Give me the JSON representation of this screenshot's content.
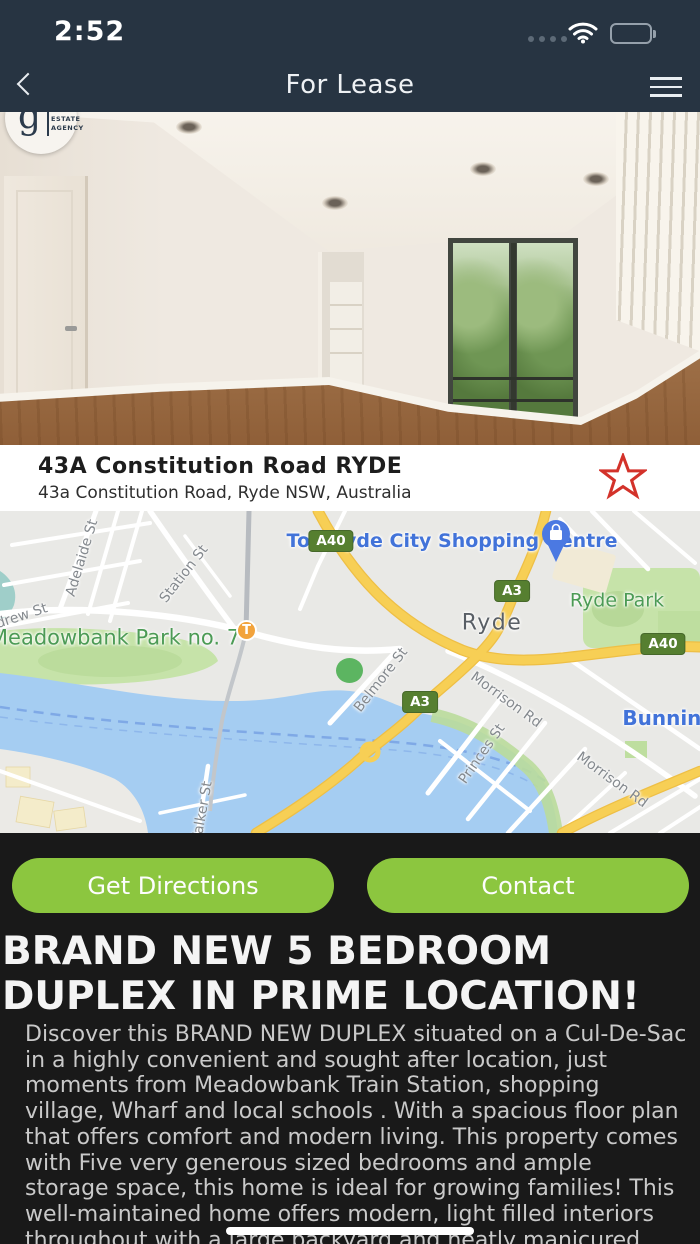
{
  "status_bar": {
    "time": "2:52"
  },
  "nav": {
    "title": "For Lease"
  },
  "agency_logo": {
    "monogram": "g",
    "text": "REAL\nESTATE\nAGENCY"
  },
  "property": {
    "title": "43A Constitution Road RYDE",
    "address": "43a Constitution Road, Ryde NSW, Australia"
  },
  "map": {
    "poi": {
      "shopping_centre_lines": [
        "Top Ryde City",
        "Shopping Centre"
      ],
      "meadowbank_park_lines": [
        "Meadowbank",
        "Park no. 7"
      ],
      "ryde_park": "Ryde Park",
      "locality": "Ryde",
      "bunnings": "Bunnings"
    },
    "shields": [
      {
        "label": "A40"
      },
      {
        "label": "A3"
      },
      {
        "label": "A40"
      },
      {
        "label": "A3"
      }
    ],
    "streets": [
      {
        "label": "Adelaide St"
      },
      {
        "label": "Station St"
      },
      {
        "label": "Andrew St"
      },
      {
        "label": "Belmore St"
      },
      {
        "label": "Morrison Rd"
      },
      {
        "label": "Princes St"
      },
      {
        "label": "Morrison Rd"
      },
      {
        "label": "Walker St"
      }
    ],
    "transit_badge": "T"
  },
  "actions": {
    "directions_label": "Get Directions",
    "contact_label": "Contact"
  },
  "listing": {
    "headline_lines": [
      "BRAND NEW 5 BEDROOM",
      "DUPLEX IN PRIME LOCATION!"
    ],
    "description_lines": [
      "Discover this BRAND NEW DUPLEX situated on a Cul-De-Sac",
      "in a highly convenient and sought after location, just",
      "moments from Meadowbank Train Station, shopping",
      "village, Wharf and local schools . With a spacious floor plan",
      "that offers comfort and modern living. This property comes",
      "with Five very generous sized bedrooms and ample",
      "storage space, this home is ideal for growing families! This",
      "throughout with a large backyard and neatly manicured"
    ],
    "description_lines_note": "line8",
    "description_line_8": "well-maintained home offers modern, light filled interiors"
  },
  "colors": {
    "header_navy": "#273442",
    "accent_green": "#8cc63f",
    "star_red": "#d3322a",
    "map_water": "#a5cdf2",
    "map_park": "#c6e3a9",
    "map_major_road": "#f7cf55"
  }
}
